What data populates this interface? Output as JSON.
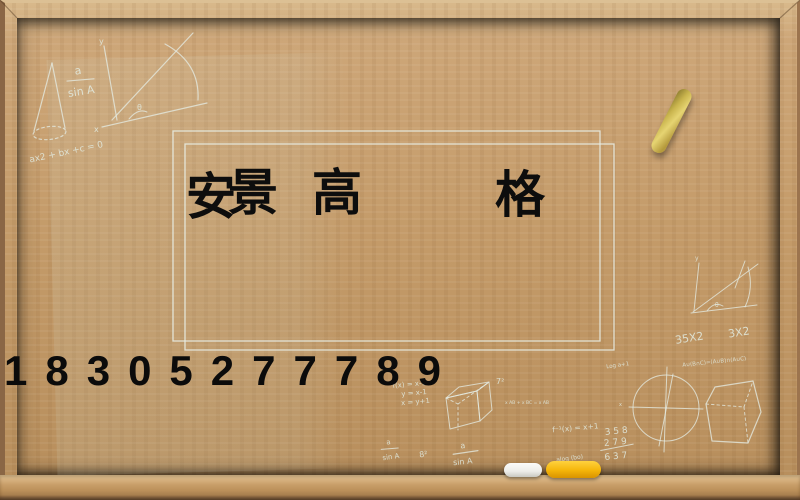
{
  "title": {
    "chars": [
      "安",
      "景",
      "高",
      "格"
    ]
  },
  "phone": {
    "number": "18305277789"
  },
  "chalk": {
    "fraction1": {
      "num": "a",
      "den": "sin A"
    },
    "axes_left": {
      "y": "y",
      "x": "x",
      "theta": "θ"
    },
    "quadratic": "ax2 + bx +c = 0",
    "axes_right": {
      "y": "y",
      "theta": "θ"
    },
    "expr_35x2": "35X2",
    "expr_3x2": "3X2",
    "log_note": "Log a+1",
    "set_identity": "A∪(B∩C)=(A∪B)∩(A∪C)",
    "circle_x": "x",
    "fx1": "f(x) = x-1",
    "fx2": "y = x-1",
    "fx3": "x = y+1",
    "seven_sq": "7²",
    "vector_note": "x AB + x BC = x AB",
    "f_inverse": "f⁻¹(x) = x+1",
    "sum_row1": "3 5 8",
    "sum_row2": "2 7 9",
    "sum_row3": "6 3 7",
    "fraction2": {
      "num": "a",
      "den": "sin A"
    },
    "eight_sq": "8²",
    "fraction3": {
      "num": "a",
      "den": "sin A"
    },
    "alog_note": "alog (bo)"
  },
  "colors": {
    "board_green_light": "#5c6e60",
    "board_green_dark": "#1e2e25",
    "wood": "#c39a68",
    "wood_dark": "#6f5134",
    "chalk_white": "#e4ebe2",
    "chalk_yellow": "#f5b50a",
    "ink_black": "#0d0d0d"
  }
}
